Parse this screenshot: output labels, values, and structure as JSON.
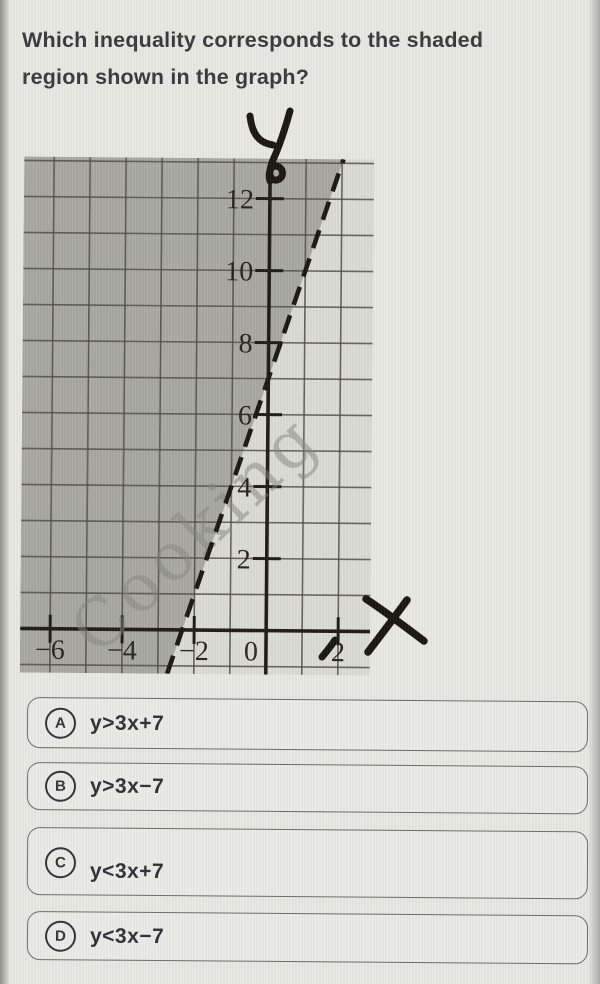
{
  "question": "Which inequality corresponds to the shaded region shown in the graph?",
  "graph": {
    "handwritten_y_axis_label": "y",
    "handwritten_x_axis_label": "x",
    "watermark": "Cooking",
    "y_ticks": [
      "2",
      "4",
      "6",
      "8",
      "10",
      "12"
    ],
    "x_ticks": [
      "−6",
      "−4",
      "−2",
      "0",
      "2"
    ]
  },
  "chart_data": {
    "type": "line",
    "title": "",
    "xlabel": "x",
    "ylabel": "y",
    "boundary_line": {
      "equation": "y = 3x + 7",
      "slope": 3,
      "y_intercept": 7,
      "x_intercept": -2.33,
      "style": "dashed"
    },
    "shaded_region": "y > 3x + 7 (region left/above the dashed line is shaded)",
    "x_axis": {
      "min": -6.8,
      "max": 2.9,
      "ticks": [
        -6,
        -4,
        -2,
        0,
        2
      ]
    },
    "y_axis": {
      "min": -1.2,
      "max": 13.1,
      "ticks": [
        2,
        4,
        6,
        8,
        10,
        12
      ]
    },
    "grid": true,
    "grid_step": 1,
    "legend": false
  },
  "options": [
    {
      "letter": "A",
      "label": "y>3x+7"
    },
    {
      "letter": "B",
      "label": "y>3x−7"
    },
    {
      "letter": "C",
      "label": "y<3x+7"
    },
    {
      "letter": "D",
      "label": "y<3x−7"
    }
  ]
}
